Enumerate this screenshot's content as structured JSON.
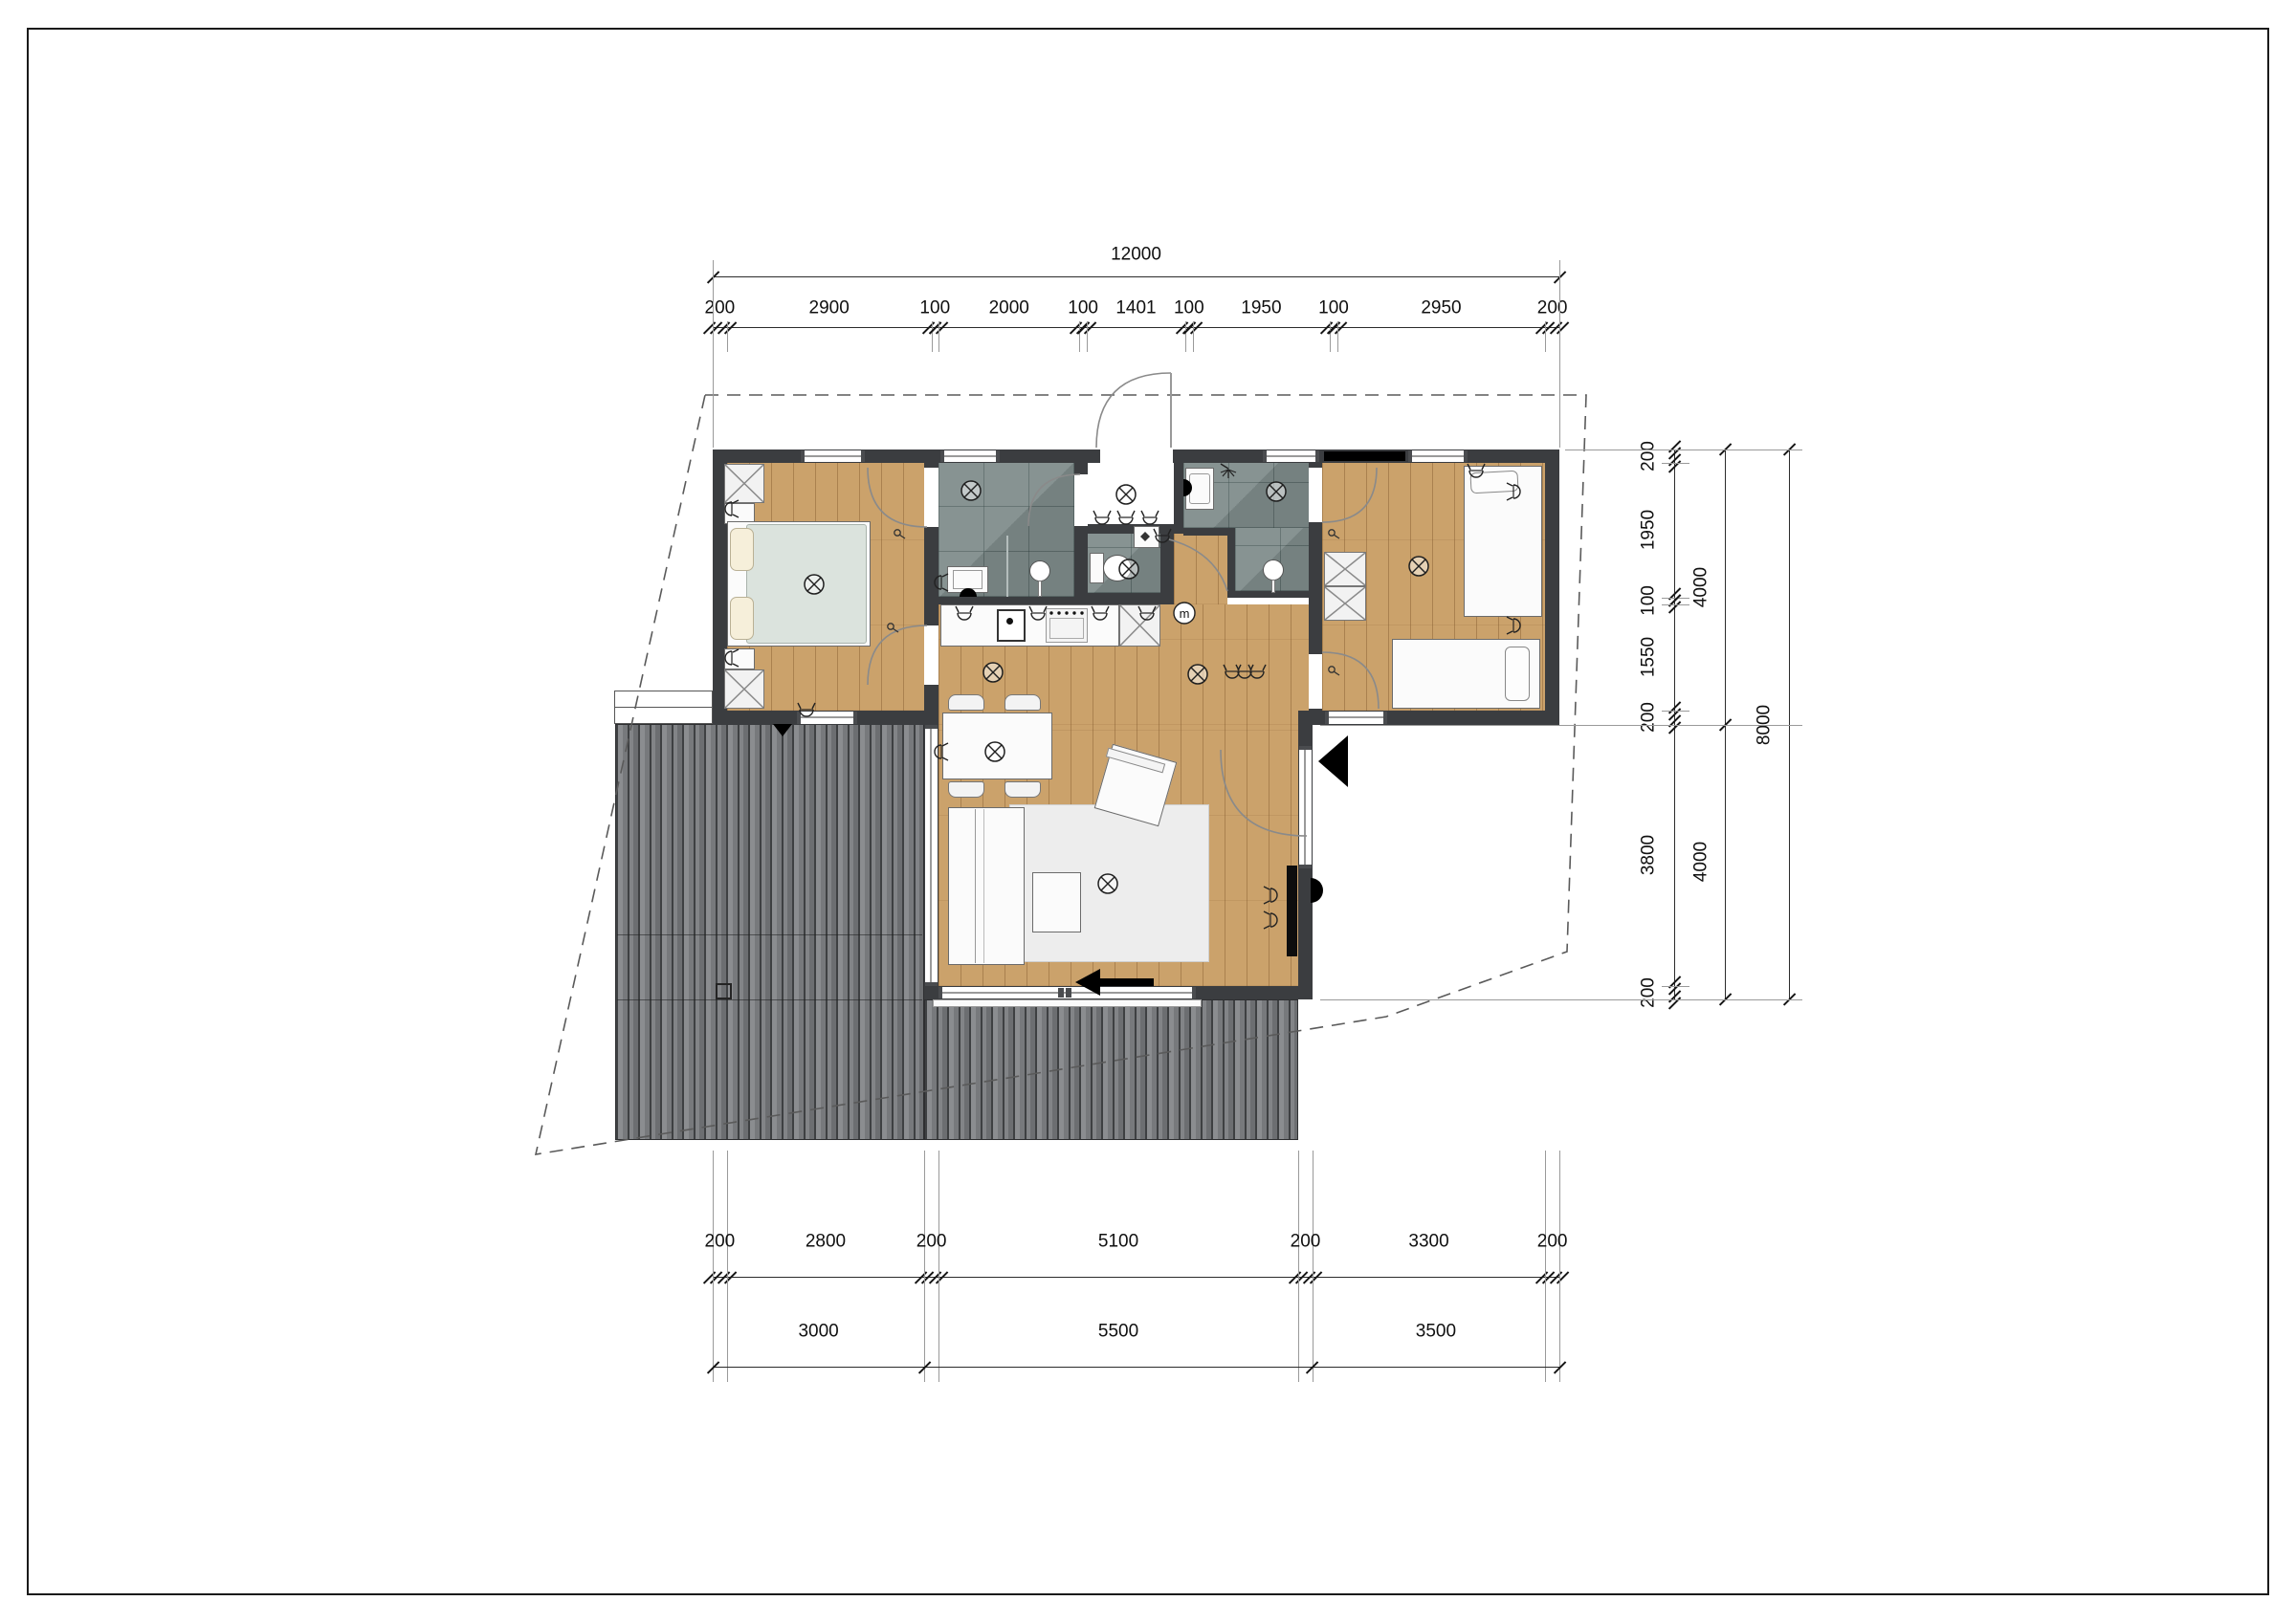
{
  "drawing": {
    "kind": "floor-plan",
    "visible_text_note": "architectural plan; only visible strings are dimension values and a circled m symbol"
  },
  "dimensions": {
    "top": {
      "total": "12000",
      "segments": [
        "200",
        "2900",
        "100",
        "2000",
        "100",
        "1401",
        "100",
        "1950",
        "100",
        "2950",
        "200"
      ]
    },
    "right": {
      "segments": [
        "200",
        "1950",
        "100",
        "1550",
        "200",
        "3800",
        "200"
      ],
      "groups": [
        "4000",
        "4000"
      ],
      "total": "8000"
    },
    "bottom": {
      "segments": [
        "200",
        "2800",
        "200",
        "5100",
        "200",
        "3300",
        "200"
      ],
      "groups": [
        "3000",
        "5500",
        "3500"
      ]
    }
  },
  "labels": {
    "meter": "m"
  },
  "icons": {
    "ceiling-light": "circle with diagonal cross",
    "wall-socket": "semicircle with prongs",
    "shower-head": "stem with spray fan",
    "meter": "circled m",
    "door-swing": "quarter arc",
    "wardrobe": "rectangle with X",
    "entrance-arrow": "solid black triangle",
    "slide-direction-arrow": "solid black left arrow",
    "vent-marker": "solid black triangle down"
  },
  "colors": {
    "paper": "#ffffff",
    "wall": "#3b3d40",
    "wood_floor": "#cba26b",
    "tile_floor": "#7e8b8a",
    "deck": "#737577",
    "bedspread": "#dbe3dd",
    "furniture": "#fbfbfb",
    "rug": "#ededed",
    "accent": "#000000"
  }
}
